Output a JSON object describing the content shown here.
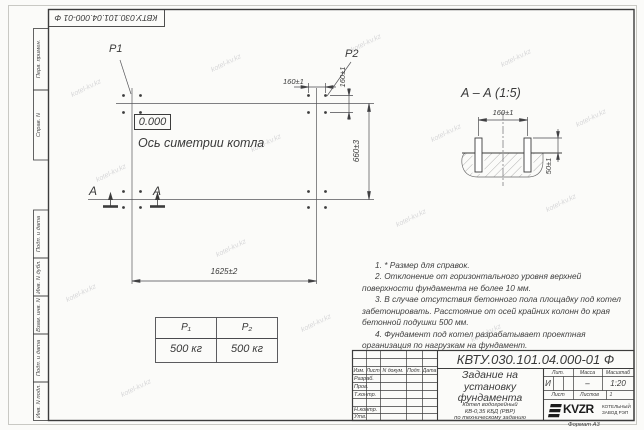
{
  "watermark": "kotel-kv.kz",
  "frame": {
    "top_stamp": "КВТУ.030.101.04.000-01 Ф",
    "left_labels": [
      "Перв. примен.",
      "Справ. N",
      "Подп. и дата",
      "Инв. N дубл.",
      "Взам. инв. N",
      "Подп. и дата",
      "Инв. N подл."
    ],
    "format_note": "Формат А3"
  },
  "plan": {
    "p1_label": "P1",
    "p2_label": "P2",
    "elevation": "0.000",
    "axis_label": "Ось симетрии котла",
    "section_letter": "А",
    "dim_width": "1625±2",
    "dim_height": "660±3",
    "dim_bolt_h": "160±1",
    "dim_bolt_v": "160±1"
  },
  "section": {
    "title": "А – А (1:5)",
    "dim_spacing": "160±1",
    "dim_protrusion": "50±1"
  },
  "notes": [
    "1. * Размер для справок.",
    "2. Отклонение от горизонтального уровня верхней поверхности фундамента не более 10 мм.",
    "3. В случае отсутствия бетонного пола площадку под котел забетонировать. Расстояние от осей крайних колонн до края бетонной подушки 500 мм.",
    "4. Фундамент под котел разрабатывает проектная организация по нагрузкам на фундамент."
  ],
  "load_table": {
    "headers": [
      "P₁",
      "P₂"
    ],
    "values": [
      "500 кг",
      "500 кг"
    ]
  },
  "title_block": {
    "doc_number": "КВТУ.030.101.04.000-01  Ф",
    "title": "Задание на установку фундамента",
    "subtitle_lines": [
      "Котел водогрейный",
      "КВ-0,35 КБД (РВР)",
      "по техническому заданию"
    ],
    "sign_headers": [
      "Изм.",
      "Лист",
      "N докум.",
      "Подп.",
      "Дата"
    ],
    "sign_rows": [
      "Разраб.",
      "Пров.",
      "Т.контр.",
      "",
      "Н.контр.",
      "Утв."
    ],
    "lit_header": "Лит.",
    "mass_header": "Масса",
    "scale_header": "Масштаб",
    "lit_value": "И",
    "mass_value": "–",
    "scale_value": "1:20",
    "sheet_label": "Лист",
    "sheets_label": "Листов",
    "sheets_value": "1",
    "logo_text": "KVZR",
    "logo_caption_line1": "КОТЕЛЬНЫЙ",
    "logo_caption_line2": "ЗАВОД РЭП"
  }
}
